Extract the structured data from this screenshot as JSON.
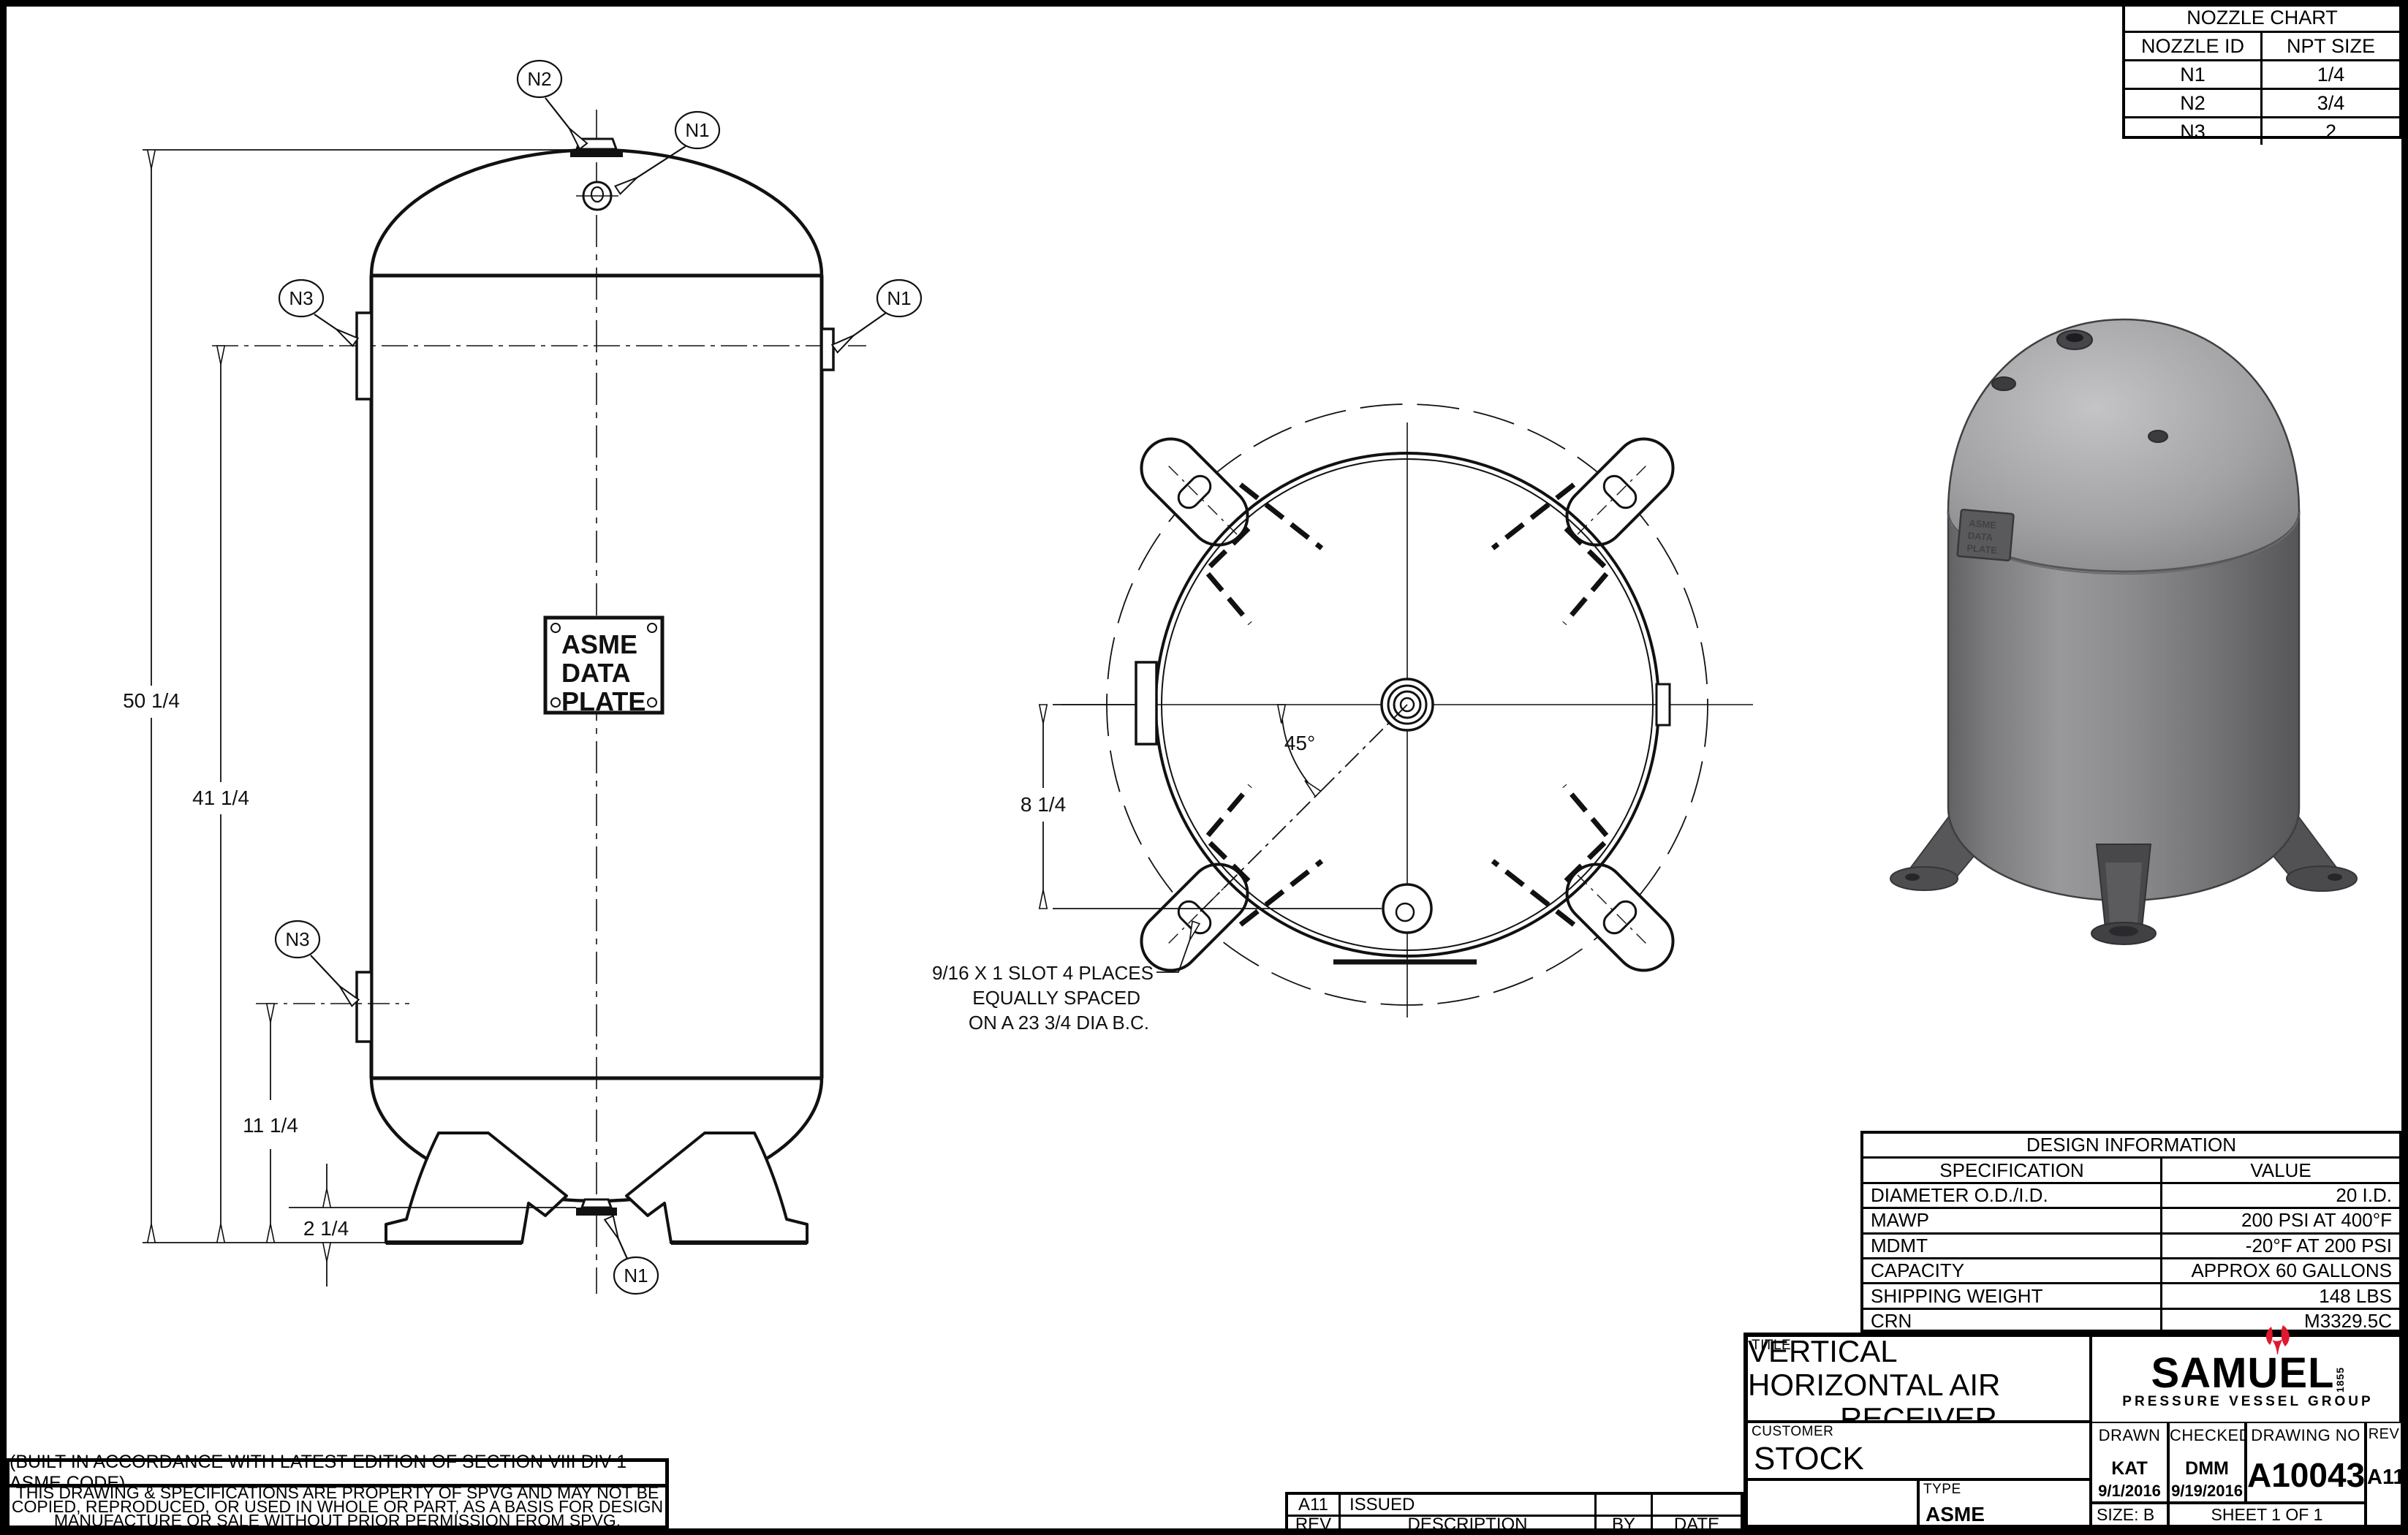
{
  "nozzle_chart": {
    "title": "NOZZLE CHART",
    "col_id": "NOZZLE ID",
    "col_size": "NPT SIZE",
    "rows": [
      {
        "id": "N1",
        "size": "1/4"
      },
      {
        "id": "N2",
        "size": "3/4"
      },
      {
        "id": "N3",
        "size": "2"
      }
    ]
  },
  "design_info": {
    "title": "DESIGN INFORMATION",
    "col_spec": "SPECIFICATION",
    "col_value": "VALUE",
    "rows": [
      {
        "spec": "DIAMETER O.D./I.D.",
        "value": "20 I.D."
      },
      {
        "spec": "MAWP",
        "value": "200 PSI AT 400°F"
      },
      {
        "spec": "MDMT",
        "value": "-20°F AT 200 PSI"
      },
      {
        "spec": "CAPACITY",
        "value": "APPROX 60 GALLONS"
      },
      {
        "spec": "SHIPPING WEIGHT",
        "value": "148 LBS"
      },
      {
        "spec": "CRN",
        "value": "M3329.5C"
      }
    ]
  },
  "title_block": {
    "title_label": "TITLE",
    "title_line1": "VERTICAL HORIZONTAL AIR",
    "title_line2": "RECEIVER",
    "customer_label": "CUSTOMER",
    "customer": "STOCK",
    "type_label": "TYPE",
    "type_value": "ASME",
    "drawn_label": "DRAWN",
    "drawn_by": "KAT",
    "drawn_date": "9/1/2016",
    "checked_label": "CHECKED",
    "checked_by": "DMM",
    "checked_date": "9/19/2016",
    "drawing_no_label": "DRAWING NO",
    "drawing_no": "A10043",
    "rev_label": "REV",
    "rev": "A11",
    "size_label": "SIZE: B",
    "sheet_label": "SHEET 1  OF 1"
  },
  "logo": {
    "name": "SAMUEL",
    "year": "1855",
    "subtitle": "PRESSURE VESSEL GROUP",
    "red": "#e0182d"
  },
  "revisions": {
    "headers": {
      "rev": "REV",
      "description": "DESCRIPTION",
      "by": "BY",
      "date": "DATE"
    },
    "rows": [
      {
        "rev": "A11",
        "description": "ISSUED",
        "by": "",
        "date": ""
      }
    ]
  },
  "notes": {
    "code_note": "(BUILT IN ACCORDANCE WITH LATEST EDITION OF SECTION VIII DIV 1 ASME CODE)",
    "prop_line1": "THIS DRAWING & SPECIFICATIONS ARE PROPERTY OF SPVG AND MAY NOT BE",
    "prop_line2": "COPIED, REPRODUCED, OR USED IN WHOLE OR PART, AS A BASIS FOR DESIGN",
    "prop_line3": "MANUFACTURE OR SALE WITHOUT PRIOR PERMISSION FROM SPVG."
  },
  "front_view": {
    "dim_overall": "50 1/4",
    "dim_upper": "41 1/4",
    "dim_lower": "11 1/4",
    "dim_bottom": "2 1/4",
    "plate_line1": "ASME",
    "plate_line2": "DATA",
    "plate_line3": "PLATE",
    "labels": {
      "n1": "N1",
      "n2": "N2",
      "n3": "N3"
    }
  },
  "bottom_view": {
    "angle": "45°",
    "dim_bc": "8 1/4",
    "note_line1": "9/16 X 1 SLOT 4 PLACES",
    "note_line2": "EQUALLY SPACED",
    "note_line3": "ON A 23 3/4 DIA B.C."
  }
}
